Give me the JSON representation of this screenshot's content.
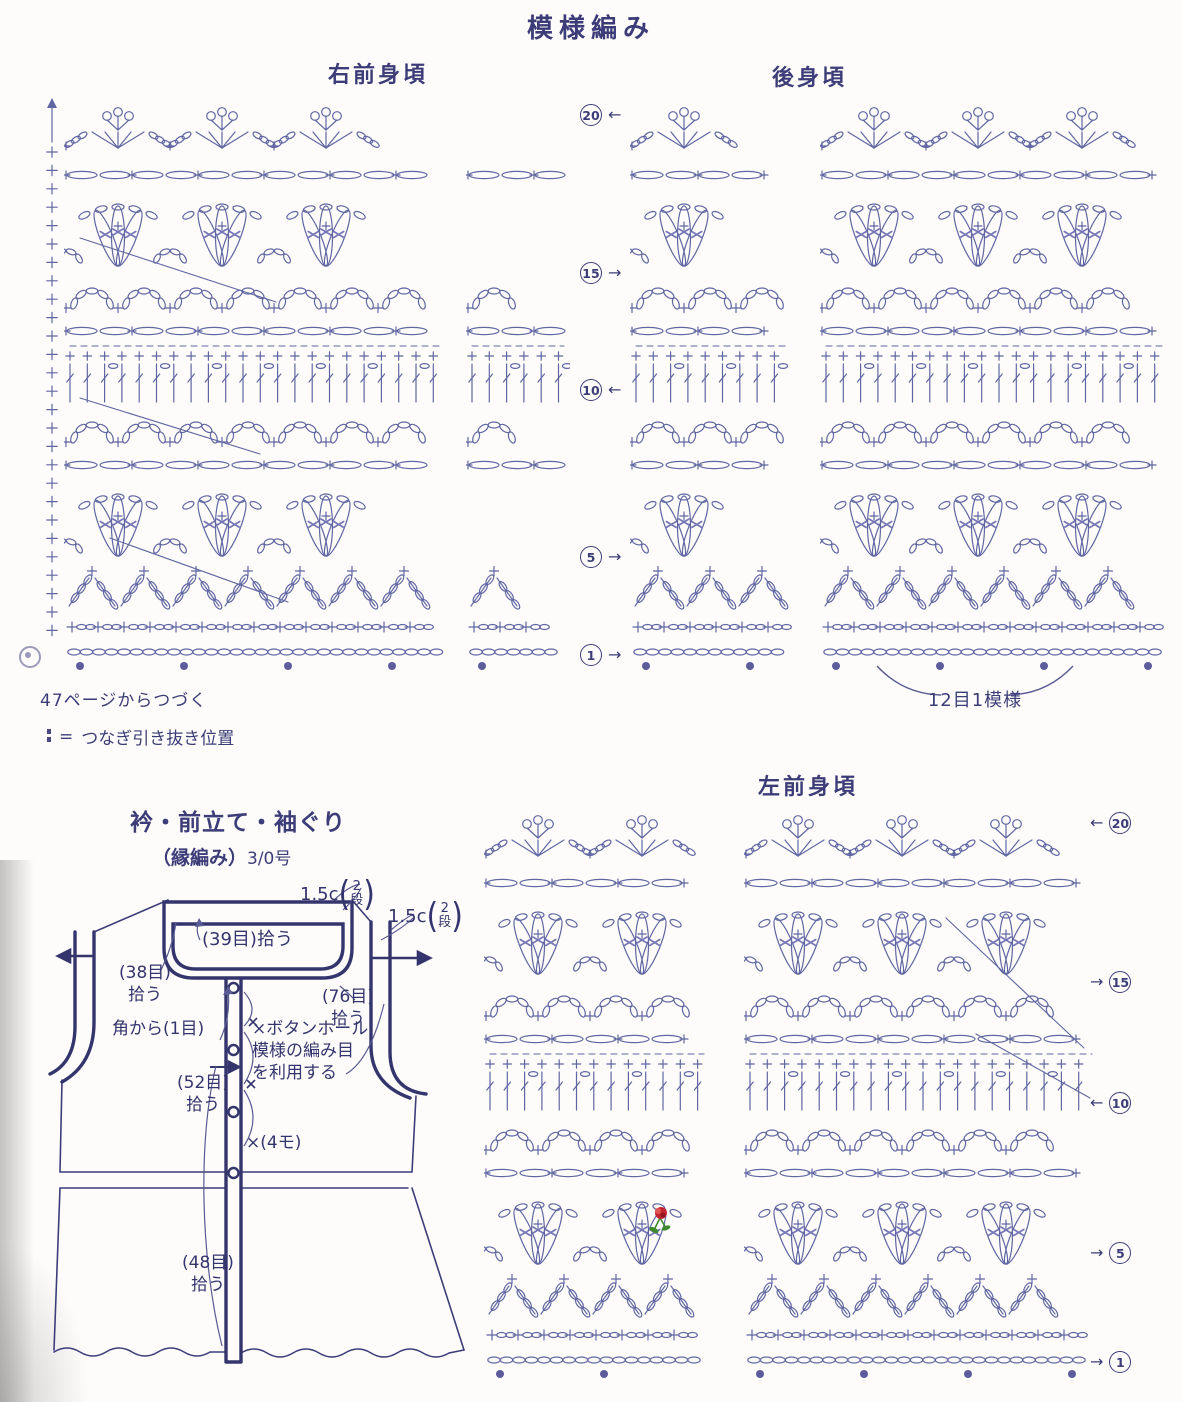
{
  "title": "模様編み",
  "colors": {
    "ink": "#3c3c78",
    "stitch": "#6066a2",
    "dot": "#5c5c9c",
    "accent": "#7576b6",
    "rose_red": "#c42432",
    "rose_green": "#3d8a2c"
  },
  "sections": {
    "right_front": "右前身頃",
    "back": "後身頃",
    "left_front": "左前身頃"
  },
  "row_markers": [
    {
      "num": "20",
      "dir": "left"
    },
    {
      "num": "15",
      "dir": "right"
    },
    {
      "num": "10",
      "dir": "left"
    },
    {
      "num": "5",
      "dir": "right"
    },
    {
      "num": "1",
      "dir": "right"
    }
  ],
  "notes": {
    "continued": "47ページからつづく",
    "legend_eq": "=",
    "legend_text": "つなぎ引き抜き位置",
    "repeat": "12目1模様"
  },
  "edging": {
    "title": "衿・前立て・袖ぐり",
    "subtitle_paren": "（縁編み）",
    "subtitle_hook": "3/0号"
  },
  "schematic_labels": {
    "neck_band_cm": "1.5c",
    "neck_band_rows_top": "2",
    "neck_band_rows_bottom": "段",
    "arm_band_cm": "1.5c",
    "arm_band_rows_top": "2",
    "arm_band_rows_bottom": "段",
    "pickup_39": "(39目)拾う",
    "pickup_38_line1": "(38目)",
    "pickup_38_line2": "拾う",
    "pickup_76_line1": "(76目)",
    "pickup_76_line2": "拾う",
    "from_corner": "角から(1目)",
    "buttonhole_x": "×",
    "buttonhole_line1": "ボタンホール",
    "buttonhole_line2": "模様の編み目",
    "buttonhole_line3": "を利用する",
    "pickup_52_line1": "(52目)",
    "pickup_52_line2": "拾う",
    "button_count": "×(4モ)",
    "pickup_48_line1": "(48目)",
    "pickup_48_line2": "拾う"
  }
}
